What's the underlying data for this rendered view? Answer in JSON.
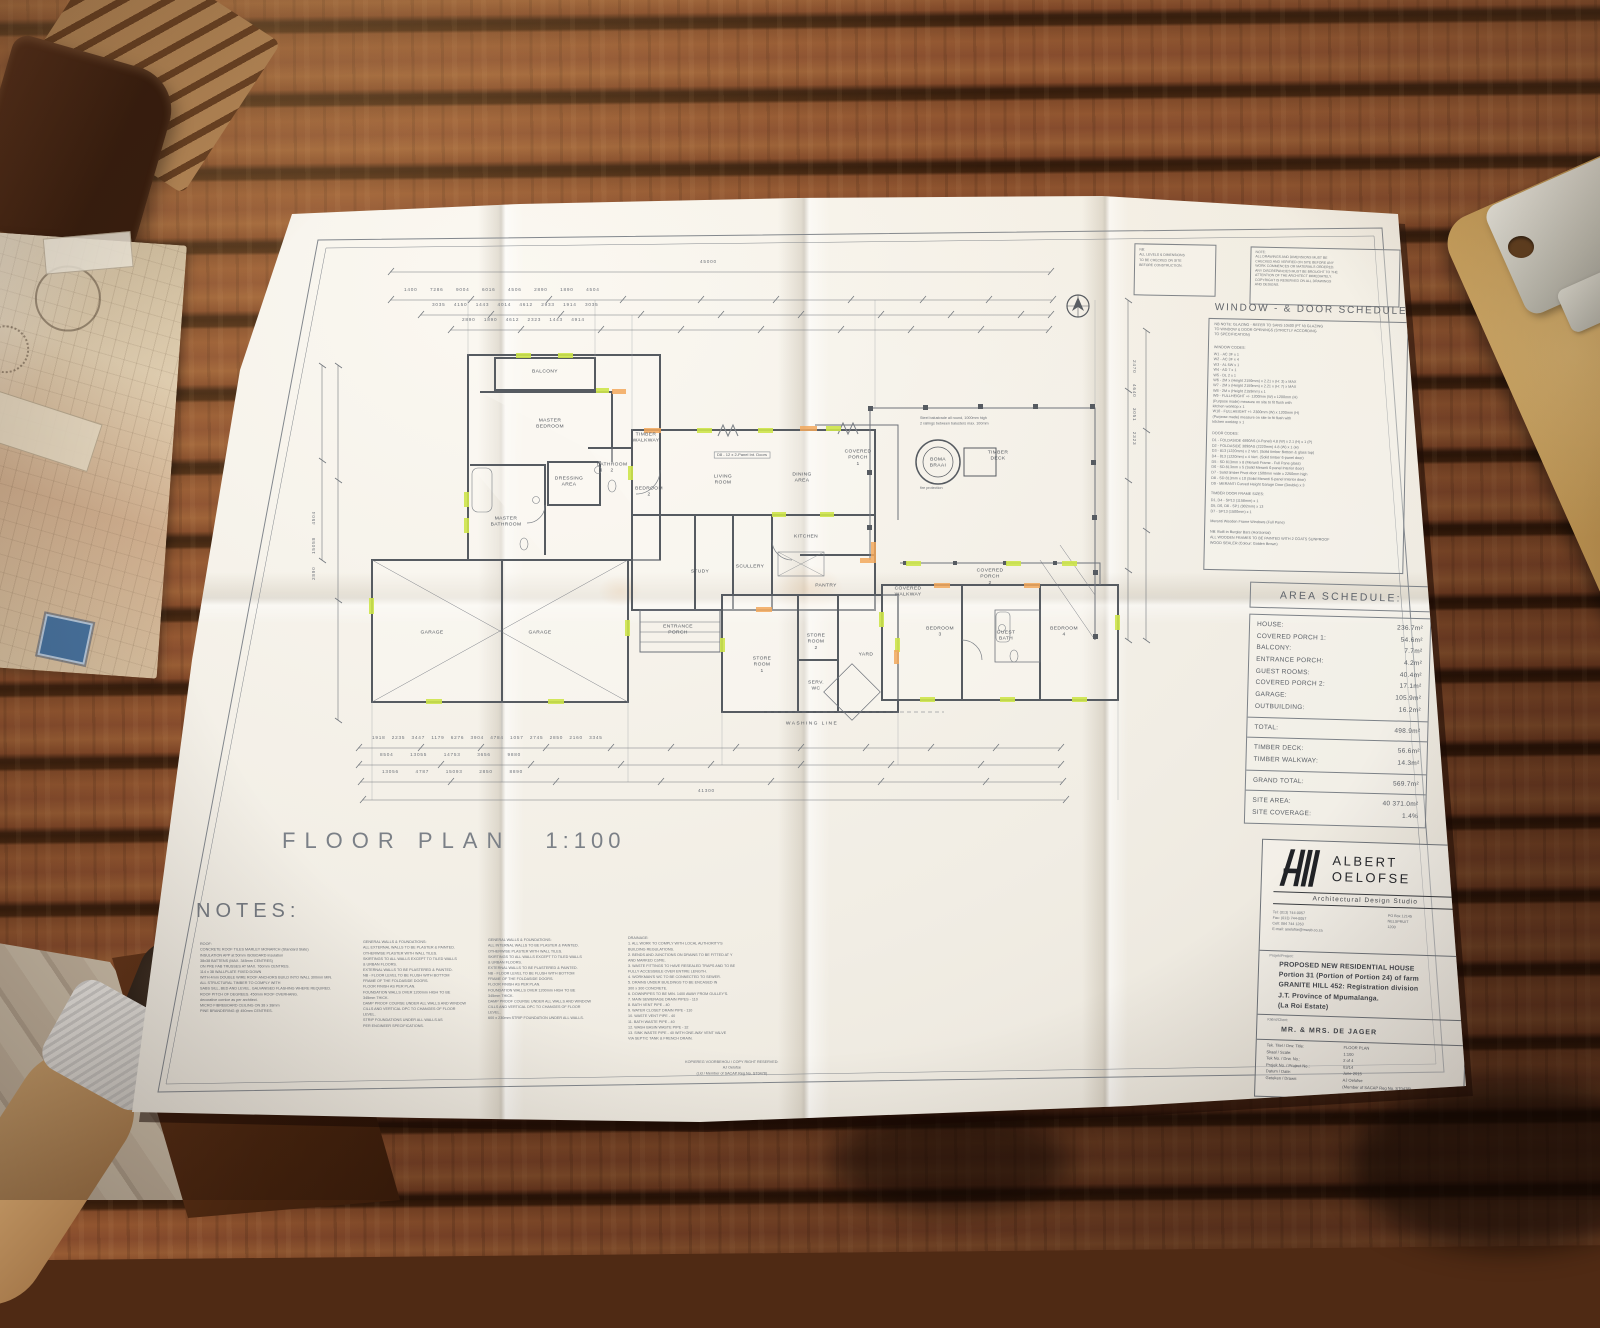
{
  "sheet": {
    "plan": {
      "title": "FLOOR PLAN",
      "scale": "1:100",
      "rooms": [
        "BALCONY",
        "MASTER\nBEDROOM",
        "MASTER\nBATHROOM",
        "DRESSING\nAREA",
        "BATHROOM\n2",
        "BEDROOM\n2",
        "TIMBER\nWALKWAY",
        "LIVING\nROOM",
        "DINING\nAREA",
        "COVERED\nPORCH\n1",
        "KITCHEN",
        "STUDY",
        "SCULLERY",
        "PANTRY",
        "BOMA\nBRAAI",
        "TIMBER\nDECK",
        "GARAGE",
        "GARAGE",
        "ENTRANCE\nPORCH",
        "STORE\nROOM\n1",
        "STORE\nROOM\n2",
        "YARD",
        "SERV.\nWC",
        "WASHING  LINE",
        "COVERED\nPORCH\n2",
        "COVERED\nWALKWAY",
        "BEDROOM\n3",
        "GUEST\nBATH",
        "BEDROOM\n4"
      ],
      "annotations": {
        "door_tag": "D8 - 12 x 2-Panel Int. Doors",
        "balustrade": "Steel balustrade all round, 1000mm high\n2 railings between balusters max. 100mm",
        "fire": "fire protection",
        "total_top": "45000",
        "total_bottom": "41300"
      },
      "dims": {
        "top1": "1400      7286      9004      6016      4506      2890      1890      4504",
        "top2": "3035    4150    1443    4014    4612    2933    1914    3035",
        "top3": "2890    1890    4612    2323    1443    4914",
        "bottom1": "1918   2235   3447   1179   6276   3904   4784   1057   2745   2850   2160   3345",
        "bottom2": "8504        13055        14753        3656        9880",
        "bottom3": "13056        4787        15093        2850        8890",
        "left": "2890      15058      4504",
        "right": "2470     4640     3051     2323"
      }
    },
    "top_notes": {
      "box1": "NB:\nALL LEVELS & DIMENSIONS\nTO BE CHECKED ON SITE\nBEFORE CONSTRUCTION.",
      "box2": "NOTE:\nALL DRAWINGS AND DIMENSIONS MUST BE\nCHECKED AND VERIFIED ON SITE BEFORE ANY\nWORK COMMENCES OR MATERIALS ORDERED.\nANY DISCREPANCIES MUST BE BROUGHT TO THE\nATTENTION OF THE ARCHITECT IMMEDIATELY.\nCOPYRIGHT IS RESERVED ON ALL DRAWINGS\nAND DESIGNS."
    },
    "window_door_schedule": {
      "title": "WINDOW - & DOOR SCHEDULE",
      "intro": "NB NOTE: GLAZING - REFER TO SANS 10400 (PT N) GLAZING\nTO WINDOW & DOOR OPENINGS (STRICTLY ACCORDING\nTO SPECIFICATION)",
      "window_header": "WINDOW CODES:",
      "windows": [
        "W1 - AC 3F        x 1",
        "W2 - AC 3F        x 4",
        "W3 - AL 5W       x 1",
        "W4 - AD 7          x 1",
        "W5 - DL 2          x 1",
        "W6 - 2M x (Height 2159mm) x 2.21 x (H: 3) x MAX",
        "W7 - 2M x (Height 2159mm) x 2.21 x (H: 7) x MAX",
        "W8 - 2M x (Height 2159mm) x 1",
        "W9 - FULLHEIGHT +/- 1200mm (W) x 1200mm (H)",
        "        (Purpose made) measure on site to fit flush with",
        "        kitchen worktop x 1",
        "W10 - FULLHEIGHT +/- 2300mm (W) x 1200mm (H)",
        "        (Purpose made) measure on site to fit flush with",
        "        kitchen worktop x 1"
      ],
      "door_header": "DOOR CODES:",
      "doors": [
        "D1 - FOLDASIDE 4890AS (4-Panel) 4.8 (W) x 2.1 (H) x 1 (P)",
        "D2 - FOLDASIDE 3890AS (2220mm) 4.8 (W) x 1 (H)",
        "D3 - 813 (1220mm) x 2 Vert. (Solid timber Bottom & glass top)",
        "D4 - 813 (1220mm) x 4 Vert. (Solid timber 6-panel door)",
        "D5 - SD 813mm x 8 (Meranti Frame - Full Pane glass)",
        "D6 - SD 813mm x 5 (Solid Meranti 6-panel Interior door)",
        "D7 - Solid timber Pivot door 1500mm wide x 2250mm high",
        "D8 - SD 813mm x 10 (Solid Meranti 6-panel Interior door)",
        "D9 - MERANTI Curved Height Garage Door (Double) x 3"
      ],
      "frame_header": "TIMBER DOOR FRAME SIZES:",
      "frames": [
        "D1, D4  -  SP13 (1158mm)  x 1",
        "D5, D6, D8  -  SP1 (902mm)  x 13",
        "D7  -  SP13 (1500mm)  x 1"
      ],
      "footer": "Meranti Wooden Frame Windows (Full Pane)\n\nNB: Built-in Burglar Bars (Horizontal)\nALL WOODEN FRAMES TO BE PAINTED WITH 2 COATS SUNPROOF\nWOOD SEALER (Colour: Golden Brown)"
    },
    "area_schedule": {
      "title": "AREA SCHEDULE:",
      "g1": [
        [
          "HOUSE:",
          "236.7m²"
        ],
        [
          "COVERED PORCH 1:",
          "54.6m²"
        ],
        [
          "BALCONY:",
          "7.7m²"
        ],
        [
          "ENTRANCE PORCH:",
          "4.2m²"
        ],
        [
          "GUEST ROOMS:",
          "40.4m²"
        ],
        [
          "COVERED PORCH 2:",
          "17.1m²"
        ],
        [
          "GARAGE:",
          "105.9m²"
        ],
        [
          "OUTBUILDING:",
          "16.2m²"
        ]
      ],
      "g2": [
        [
          "TOTAL:",
          "498.9m²"
        ]
      ],
      "g3": [
        [
          "TIMBER DECK:",
          "56.6m²"
        ],
        [
          "TIMBER WALKWAY:",
          "14.3m²"
        ]
      ],
      "g4": [
        [
          "GRAND TOTAL:",
          "569.7m²"
        ]
      ],
      "g5": [
        [
          "SITE AREA:",
          "40 371.0m²"
        ],
        [
          "SITE COVERAGE:",
          "1.4%"
        ]
      ]
    },
    "title_block": {
      "name_line1": "ALBERT",
      "name_line2": "OELOFSE",
      "subtitle": "Architectural Design Studio",
      "contact_left": "Tel:  (013) 744-0057\nFax: (013) 744-0057\nCell:  084 744 1263\nE-mail: aoelofse@mweb.co.za",
      "contact_right": "PO Box 12145\nNELSPRUIT\n1200",
      "project_label": "Projek/Project:",
      "project": "PROPOSED NEW RESIDENTIAL HOUSE\nPortion 31 (Portion of Portion 24) of farm\nGRANITE HILL 452: Registration division\nJ.T. Province of Mpumalanga.\n(La Roi Estate)",
      "client_label": "Kliënt/Client:",
      "client": "MR. & MRS. DE JAGER",
      "meta_labels": [
        "Tek. Titel / Drw. Title:",
        "Skaal / Scale:",
        "Tek No. / Drw. No.:",
        "Projek No. / Project No.:",
        "Datum / Date:",
        "Geteken / Drawn:",
        ""
      ],
      "meta_values": [
        "FLOOR PLAN",
        "1:100",
        "2 of 4",
        "03/14",
        "June 2015",
        "AJ Oelofse",
        "(Member of SACAP Reg No. ST0478)"
      ]
    },
    "notes": {
      "heading": "NOTES:",
      "col1": [
        "ROOF:",
        "CONCRETE ROOF TILES MARLEY MONARCH (Standard Slate)",
        "INSULATION APP at 50mm ISOBOARD insulation",
        "38x38 BATTENS (MAX. 345mm CENTRES)",
        "ON PRE FAB TRUSSES AT MAX. 760mm CENTRES.",
        "114 x 38 WALLPLATE FIXED DOWN",
        "WITH 4mm DOUBLE WIRE ROOF ANCHORS BUILD INTO WALL 300mm MIN.",
        "ALL STRUCTURAL TIMBER TO COMPLY WITH",
        "SABS SILL, BED AND LEVEL. GALVANISED FLASHING WHERE REQUIRED.",
        "ROOF PITCH OF DEGREES. 450mm ROOF OVERHANG.",
        "decorative cornice as per architect.",
        "MICRO FIBREBOARD CEILING ON 38 x 38mm",
        "PINE BRANDERING @ 450mm CENTRES."
      ],
      "col2": [
        "GENERAL WALLS & FOUNDATIONS:",
        "ALL EXTERNAL WALLS TO BE PLASTER & PAINTED.",
        "OTHERWISE PLASTER WITH WALL TILES.",
        "SKIRTINGS TO ALL WALLS EXCEPT TO TILED WALLS",
        "& URBAN FLOORS.",
        "EXTERNAL WALLS TO BE PLASTERED & PAINTED.",
        "NB  -  FLOOR LEVEL TO BE FLUSH WITH BOTTOM",
        "          FRAME OF THE FOLDASIDE DOORS.",
        "          FLOOR FINISH AS PER PLAN.",
        "FOUNDATION WALLS OVER 1200mm HIGH TO BE",
        "345mm THICK.",
        "DAMP PROOF COURSE UNDER ALL WALLS AND WINDOW",
        "CILLS AND VERTICAL DPC TO CHANGES OF FLOOR",
        "LEVEL.",
        "STRIP FOUNDATIONS UNDER ALL WALLS AS",
        "PER ENGINEER SPECIFICATIONS."
      ],
      "col3": [
        "GENERAL WALLS & FOUNDATIONS:",
        "ALL INTERNAL WALLS TO BE PLASTER & PAINTED.",
        "OTHERWISE PLASTER WITH WALL TILES.",
        "SKIRTINGS TO ALL WALLS EXCEPT TO TILED WALLS",
        "& URBAN FLOORS.",
        "EXTERNAL WALLS TO BE PLASTERED & PAINTED.",
        "NB  -  FLOOR LEVEL TO BE FLUSH WITH BOTTOM",
        "          FRAME OF THE FOLDASIDE DOORS.",
        "          FLOOR FINISH AS PER PLAN.",
        "FOUNDATION WALLS OVER 1200mm HIGH TO BE",
        "345mm THICK.",
        "DAMP PROOF COURSE UNDER ALL WALLS AND WINDOW",
        "CILLS AND VERTICAL DPC TO CHANGES OF FLOOR",
        "LEVEL.",
        "600 x 230mm STRIP FOUNDATION UNDER ALL WALLS."
      ],
      "col4": [
        "DRAINAGE:",
        "1.  ALL WORK TO COMPLY WITH LOCAL AUTHORITY'S",
        "     BUILDING REGULATIONS.",
        "2.  BENDS AND JUNCTIONS ON DRAINS TO BE FITTED AT Y",
        "     AND MARKED CJ/RE.",
        "3.  WASTE FITTINGS TO HAVE RESEALED TRAPS AND TO BE",
        "     FULLY ACCESSIBLE OVER ENTIRE LENGTH.",
        "4.  WORKMAN'S WC TO BE CONNECTED TO SEWER.",
        "5.  DRAINS UNDER BUILDINGS TO BE ENCASED IN",
        "     300 x 300 CONCRETE.",
        "6.  DOWNPIPES TO BE MIN. 1400 AWAY FROM GULLEY'S.",
        "7.  MAIN SEWERAGE DRAIN PIPES  -  110",
        "8.  BATH VENT PIPE  -  40",
        "9.  WATER CLOSET DRAIN PIPE  -  110",
        "10. WASTE VENT PIPE  -  40",
        "11. BATH WASTE PIPE  -  40",
        "12. WASH BASIN WASTE PIPE  -  32",
        "13. SINK WASTE PIPE  -  40 WITH ONE-WAY VENT VALVE",
        "     VIA SEPTIC TANK & FRENCH DRAIN."
      ]
    },
    "copyright": "KOPIEREG VOORBEHOU / COPY RIGHT RESERVED:\nAJ Oelofse\n(Lid / Member of SACAP Reg No. ST0478)"
  }
}
